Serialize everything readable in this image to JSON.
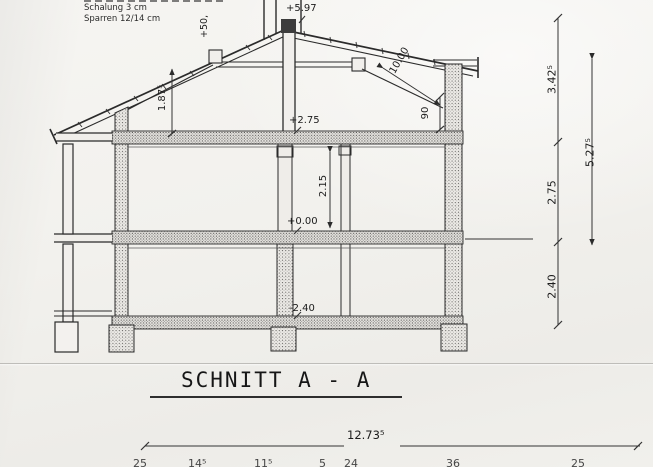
{
  "title": "SCHNITT A - A",
  "notes": {
    "schalung": "Schalung 3 cm",
    "sparren": "Sparren  12/14 cm"
  },
  "levels": {
    "chimney_partial": "+50,",
    "ridge": "+5.97",
    "upper_floor": "+2.75",
    "ground_floor": "+0.00",
    "basement": "-2.40"
  },
  "dimensions": {
    "attic_clear_height": "1.87⁵",
    "ground_room_height": "2.15",
    "knee_wall_height": "90",
    "rafter_length": "10.00",
    "attic_storey": "3.42⁵",
    "ground_storey": "2.75",
    "basement_storey": "2.40",
    "inner_span": "5.27⁵",
    "total_width": "12.73⁵",
    "bottom_segments": [
      "25",
      "14⁵",
      "11⁵",
      "5",
      "24",
      "36",
      "25"
    ]
  },
  "colors": {
    "ink": "#2b2b2b",
    "paper": "#f2f1ed"
  }
}
